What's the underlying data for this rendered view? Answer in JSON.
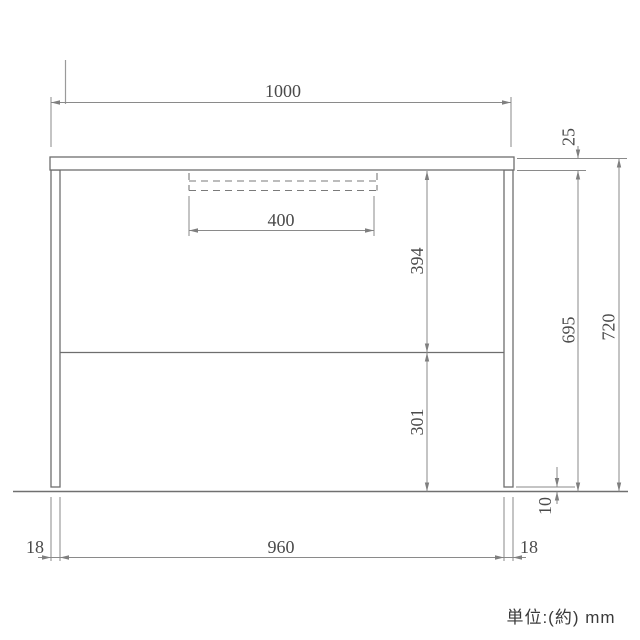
{
  "drawing": {
    "unit_note": "単位:(約) mm",
    "dimensions": {
      "top_width": "1000",
      "top_thickness": "25",
      "drawer_width": "400",
      "apron_to_shelf": "394",
      "shelf_to_floor": "301",
      "under_top_height": "695",
      "overall_height": "720",
      "adjuster_height": "10",
      "left_leg_thickness": "18",
      "inner_width": "960",
      "right_leg_thickness": "18"
    }
  }
}
